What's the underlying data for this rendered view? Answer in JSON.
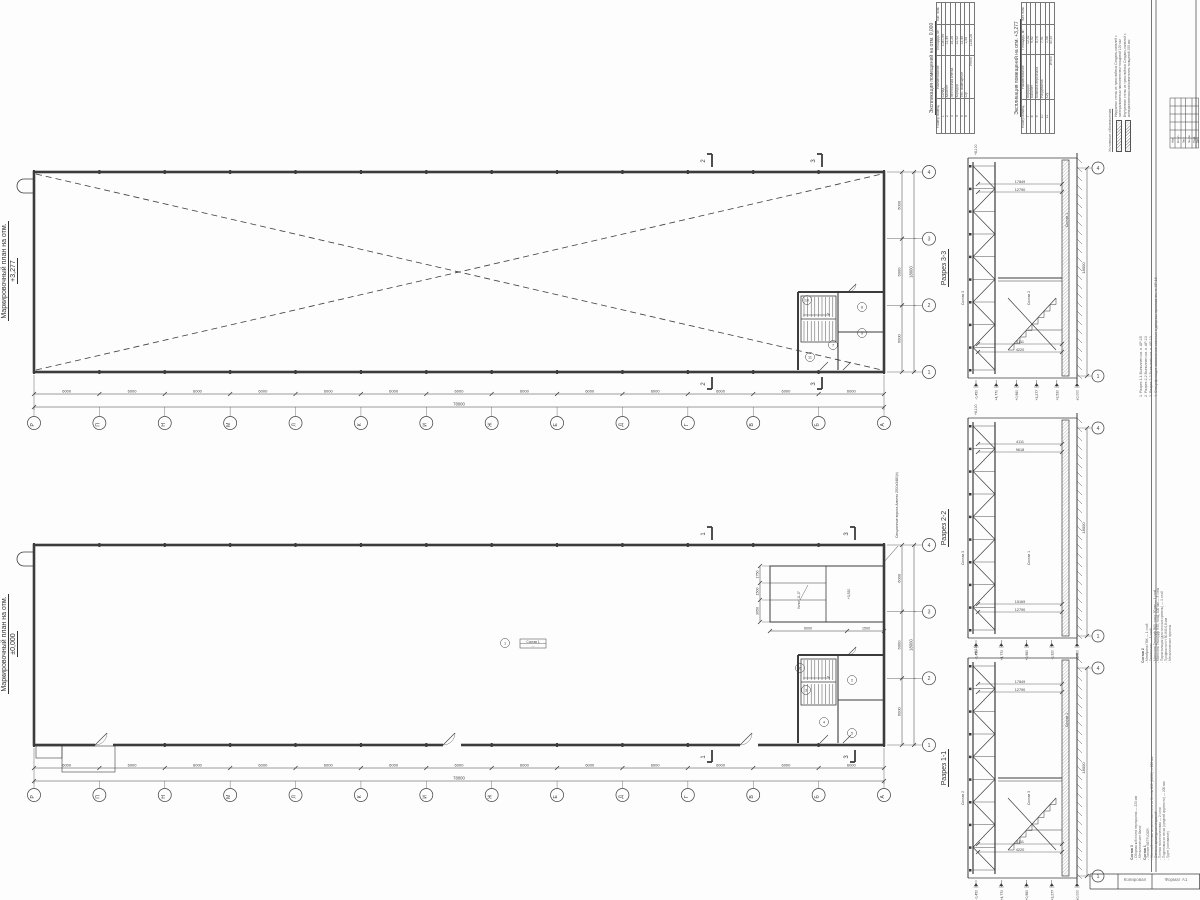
{
  "plans": {
    "top": {
      "title": "Маркировочный план на отм.",
      "level": "+3,277",
      "cut_labels": [
        "2",
        "3"
      ]
    },
    "bottom": {
      "title": "Маркировочный план на отм.",
      "level": "±0,000",
      "cut_labels": [
        "1",
        "3"
      ],
      "floor_tag": "Состав 1"
    }
  },
  "grid": {
    "letters": [
      "Р",
      "П",
      "Н",
      "М",
      "Л",
      "К",
      "И",
      "Ж",
      "Е",
      "Д",
      "Г",
      "В",
      "Б",
      "А"
    ],
    "numbers": [
      "1",
      "2",
      "3",
      "4"
    ],
    "bay": "6000",
    "total": "78000",
    "width_bay": "6000",
    "width_total": "18000"
  },
  "rooms": {
    "top": [
      "7",
      "8",
      "9",
      "10",
      "11"
    ],
    "bottom": [
      "1",
      "2",
      "3",
      "4",
      "5",
      "6"
    ]
  },
  "mezzanine": {
    "side_dims": [
      "1750",
      "1500",
      "3050"
    ],
    "bottom_dims": [
      "6000",
      "1500"
    ],
    "slope": "Уклон 11,3°",
    "level": "+3,530",
    "gate_note": "Секционные ворота Алютех 2500х3480(h)"
  },
  "sections": [
    {
      "label": "Разрез 3-3",
      "dims_top": [
        "17849",
        "12790"
      ],
      "dims_bottom": [
        "4220",
        "4111"
      ],
      "dim_total": "18000",
      "level_top": "+8,100",
      "levels": [
        "-0,450",
        "+4,770",
        "+0,980",
        "+3,277",
        "+3,530",
        "±0,000"
      ],
      "bubble_top": "4",
      "bubble_bottom": "1",
      "tags": [
        "Состав 3",
        "Состав 2",
        "Состав 1"
      ]
    },
    {
      "label": "Разрез 2-2",
      "dims_top": [
        "4111",
        "9618"
      ],
      "dims_bottom": [
        "12790",
        "15169"
      ],
      "dim_total": "18000",
      "level_top": "+8,100",
      "levels": [
        "-0,450",
        "+4,770",
        "+0,980",
        "-0,320",
        "±0,000"
      ],
      "bubble_top": "4",
      "bubble_bottom": "1",
      "tags": [
        "Состав 3",
        "Состав 1"
      ]
    },
    {
      "label": "Разрез 1-1",
      "dims_top": [
        "17849",
        "12790"
      ],
      "dims_bottom": [
        "4220",
        "4111"
      ],
      "dim_total": "18000",
      "level_top": "+8,100",
      "levels": [
        "-0,450",
        "+4,770",
        "+0,980",
        "+3,277",
        "±0,000"
      ],
      "bubble_top": "4",
      "bubble_bottom": "1",
      "tags": [
        "Состав 2",
        "Состав 3",
        "Состав 1"
      ]
    }
  ],
  "tables": [
    {
      "title": "Экспликация помещений на отм.",
      "title2": "0,000",
      "headers": [
        "Номер помещ.",
        "Наименование",
        "Площадь, м²",
        "Кат. пом."
      ],
      "rows": [
        [
          "1",
          "Склад",
          "1080,94"
        ],
        [
          "2",
          "Кабинет",
          "13,49"
        ],
        [
          "3",
          "Лестничная клетка",
          "16,26"
        ],
        [
          "4",
          "Коридор",
          "12,52"
        ],
        [
          "5",
          "Тех. помещение",
          "13,49"
        ],
        [
          "6",
          "С/у",
          "1,58"
        ]
      ],
      "total_label": "Итого",
      "total": "1138,28"
    },
    {
      "title": "Экспликация помещений на отм.",
      "title2": "+3,277",
      "headers": [
        "Номер помещ.",
        "Наименование",
        "Площадь, м²",
        "Кат. пом."
      ],
      "rows": [
        [
          "7",
          "Коридор",
          "12,52"
        ],
        [
          "8",
          "Кабинет",
          "9,92"
        ],
        [
          "9",
          "Комната персонала",
          "8,74"
        ],
        [
          "10",
          "Раздевалка",
          "7,91"
        ],
        [
          "11",
          "С/у",
          "1,58"
        ]
      ],
      "total_label": "Итого",
      "total": "40,67"
    }
  ],
  "legend": {
    "title": "Условные обозначения",
    "items": [
      "Наружные стены из трехслойных Сэндвич-панелей с минераловатным наполнителем толщиной 120 мм",
      "Внутренние стены из трехслойных Сэндвич-панелей с минераловатным наполнителем толщиной 100 мм"
    ]
  },
  "notes": {
    "items": [
      "1. Разрез 1-1 Выполнен см. л. АР-15",
      "2. Разрез 2-2 Выполнен см. л. АР-13",
      "3. Разрез 3-3 Выполнен см. л. АР-13",
      "4. Спецификация заполнения оконных и дверных проемов см. л. АР-16"
    ]
  },
  "compositions": [
    {
      "title": "Состав 2",
      "items": [
        "Мембрана ПВХ — 1 слой",
        "Геотекстиль — 1 слой",
        "Минплита Техноруф В60, толщ. 50 мм — 1 слой",
        "Минплита Техноруф Н30, толщ. 100 мм — 3 слоя",
        "Пароизоляция (для плоских кровель) — 1 слой",
        "Профнастил Н 60.845.0,8 мм",
        "Металлические прогоны"
      ]
    },
    {
      "title": "Состав 3",
      "items": [
        "Сборная ж/б плита перекрытия — 220 мм",
        "Металлические балки"
      ]
    },
    {
      "title": "Состав 1",
      "items": [
        "Топпинг BETFLOOR",
        "Железобетонная монолитная плита из бетона В15 (М200) — 200 мм",
        "Сетка из арматурных стержней",
        "Пленка полиэтиленовая — 2 слоя",
        "Подготовка из песка (средней крупности) — 200 мм",
        "Грунт (основание)"
      ]
    }
  ],
  "titleblock": {
    "rev_headers": [
      "Изм.",
      "Кол.уч.",
      "Лист",
      "№ док.",
      "Подп.",
      "Дата"
    ],
    "footer": [
      "Копировал",
      "Формат А1"
    ]
  }
}
